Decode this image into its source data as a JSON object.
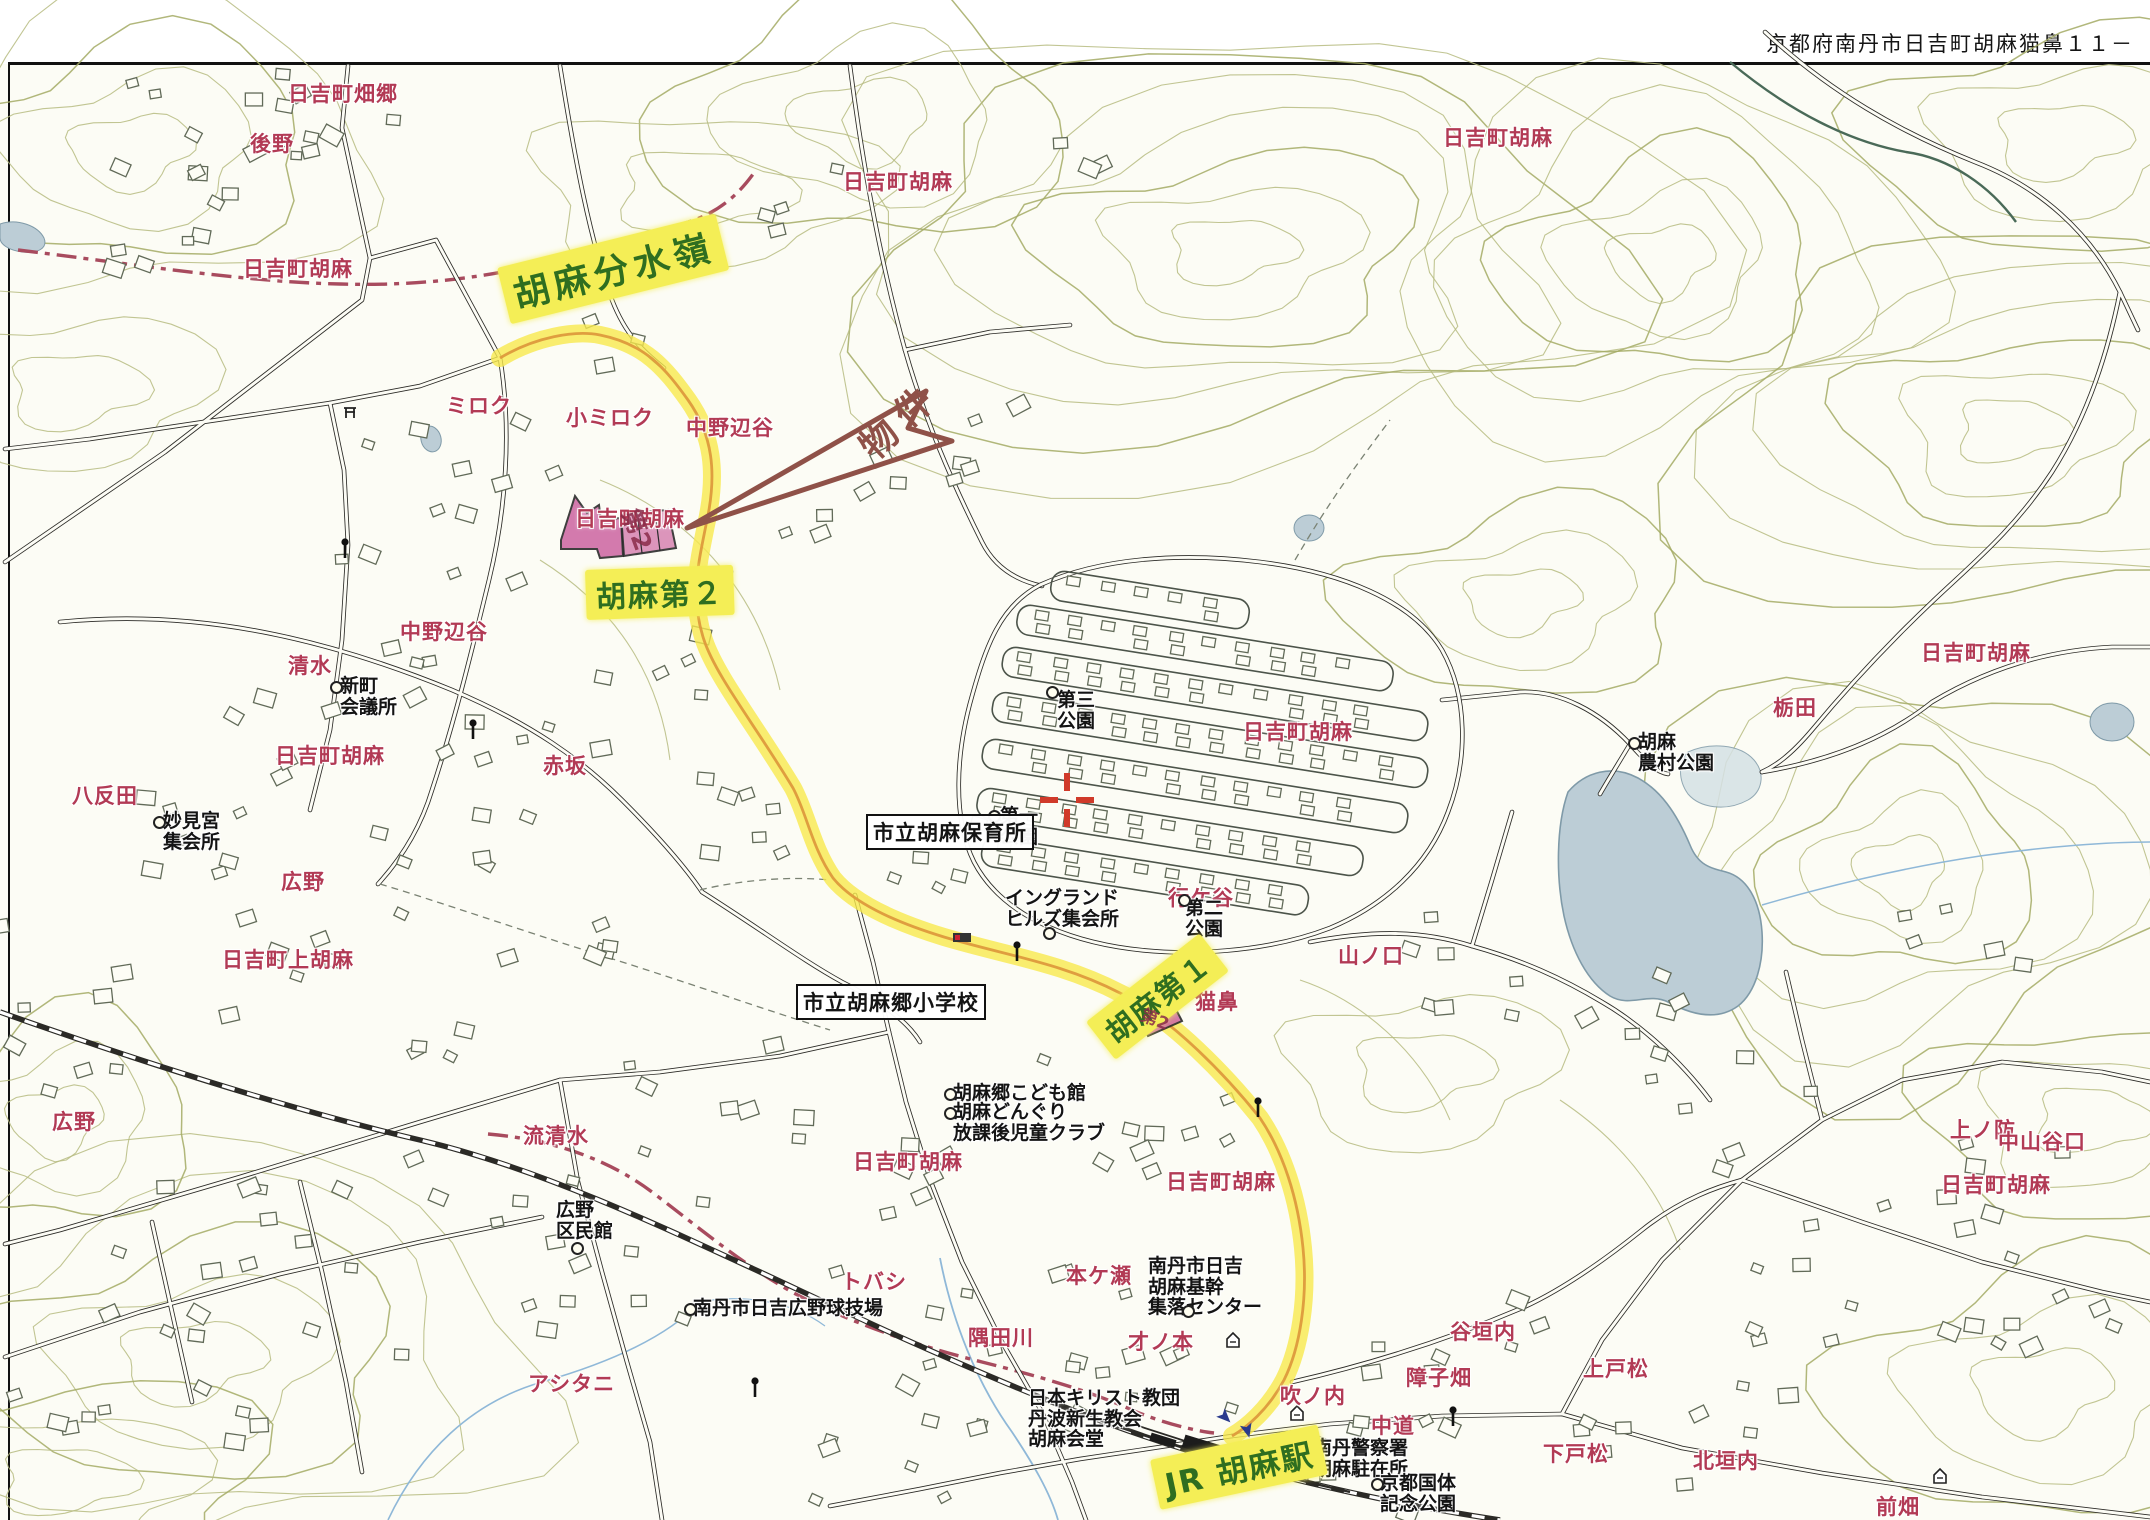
{
  "header": {
    "address_label": "京都府南丹市日吉町胡麻猫鼻１１－"
  },
  "map": {
    "colors": {
      "route_highlight": "#f8e84e",
      "route_center": "#dd9a3c",
      "label_highlight_bg": "#f4ee56",
      "label_highlight_text": "#2f6e20",
      "place_name_red": "#b23a55",
      "boundary_red": "#a84b5e",
      "flag_maroon": "#8f5148",
      "water_blue": "#bccdd6",
      "contour_olive": "#b6bb80",
      "property_pink": "#cf6da6",
      "crosshair_red": "#d03a2a",
      "rail_black": "#2b2a26"
    },
    "highlight_labels": [
      {
        "t": "胡麻分水嶺",
        "x": 497,
        "y": 268,
        "rot": -14,
        "size": 36,
        "ls": 5
      },
      {
        "t": "胡麻第２",
        "x": 585,
        "y": 570,
        "rot": -2,
        "size": 30,
        "ls": 2
      },
      {
        "t": "胡麻第１",
        "x": 1086,
        "y": 1022,
        "rot": -38,
        "size": 29,
        "ls": 2
      },
      {
        "t": "JR 胡麻駅",
        "x": 1150,
        "y": 1460,
        "rot": -12,
        "size": 31,
        "ls": 2
      }
    ],
    "flag_label": {
      "t": "物件",
      "x": 845,
      "y": 430,
      "rot": -43,
      "size": 37,
      "ls": 10
    },
    "handwritten_marks": [
      {
        "t": "第2",
        "x": 648,
        "y": 503,
        "rot": 70,
        "size": 25
      },
      {
        "t": "第2",
        "x": 1147,
        "y": 1001,
        "rot": 22,
        "size": 17
      }
    ],
    "red_labels": [
      {
        "t": "日吉町畑郷",
        "x": 288,
        "y": 78
      },
      {
        "t": "後野",
        "x": 250,
        "y": 128
      },
      {
        "t": "日吉町胡麻",
        "x": 243,
        "y": 253
      },
      {
        "t": "ミロク",
        "x": 446,
        "y": 390
      },
      {
        "t": "小ミロク",
        "x": 566,
        "y": 402
      },
      {
        "t": "中野辺谷",
        "x": 686,
        "y": 412
      },
      {
        "t": "中野辺谷",
        "x": 400,
        "y": 616
      },
      {
        "t": "清水",
        "x": 288,
        "y": 650
      },
      {
        "t": "八反田",
        "x": 72,
        "y": 780
      },
      {
        "t": "日吉町胡麻",
        "x": 575,
        "y": 503
      },
      {
        "t": "日吉町胡麻",
        "x": 275,
        "y": 740
      },
      {
        "t": "赤坂",
        "x": 543,
        "y": 750
      },
      {
        "t": "広野",
        "x": 281,
        "y": 866
      },
      {
        "t": "日吉町上胡麻",
        "x": 222,
        "y": 944
      },
      {
        "t": "広野",
        "x": 52,
        "y": 1106
      },
      {
        "t": "流清水",
        "x": 523,
        "y": 1120
      },
      {
        "t": "アシタニ",
        "x": 528,
        "y": 1368
      },
      {
        "t": "トバシ",
        "x": 841,
        "y": 1266
      },
      {
        "t": "隅田川",
        "x": 968,
        "y": 1322
      },
      {
        "t": "才ノ本",
        "x": 1128,
        "y": 1326
      },
      {
        "t": "本ケ瀬",
        "x": 1066,
        "y": 1260
      },
      {
        "t": "日吉町胡麻",
        "x": 853,
        "y": 1146
      },
      {
        "t": "日吉町胡麻",
        "x": 1166,
        "y": 1166
      },
      {
        "t": "吹ノ内",
        "x": 1280,
        "y": 1380
      },
      {
        "t": "中道",
        "x": 1371,
        "y": 1410
      },
      {
        "t": "障子畑",
        "x": 1406,
        "y": 1362
      },
      {
        "t": "谷垣内",
        "x": 1450,
        "y": 1316
      },
      {
        "t": "上戸松",
        "x": 1583,
        "y": 1353
      },
      {
        "t": "下戸松",
        "x": 1543,
        "y": 1438
      },
      {
        "t": "北垣内",
        "x": 1693,
        "y": 1445
      },
      {
        "t": "前畑",
        "x": 1876,
        "y": 1491
      },
      {
        "t": "山ノ口",
        "x": 1338,
        "y": 940
      },
      {
        "t": "行ケ谷",
        "x": 1168,
        "y": 882
      },
      {
        "t": "猫鼻",
        "x": 1195,
        "y": 986
      },
      {
        "t": "栃田",
        "x": 1773,
        "y": 692
      },
      {
        "t": "日吉町胡麻",
        "x": 843,
        "y": 166
      },
      {
        "t": "日吉町胡麻",
        "x": 1443,
        "y": 122
      },
      {
        "t": "日吉町胡麻",
        "x": 1921,
        "y": 637
      },
      {
        "t": "日吉町胡麻",
        "x": 1243,
        "y": 716
      },
      {
        "t": "上ノ防",
        "x": 1950,
        "y": 1114
      },
      {
        "t": "中山谷口",
        "x": 1998,
        "y": 1126
      },
      {
        "t": "日吉町胡麻",
        "x": 1941,
        "y": 1169
      }
    ],
    "black_labels": [
      {
        "lines": [
          "新町",
          "会議所"
        ],
        "x": 340,
        "y": 676,
        "dot": {
          "x": 330,
          "y": 681
        }
      },
      {
        "lines": [
          "妙見宮",
          "集会所"
        ],
        "x": 163,
        "y": 811,
        "dot": {
          "x": 153,
          "y": 816
        }
      },
      {
        "lines": [
          "第三",
          "公園"
        ],
        "x": 1057,
        "y": 690,
        "dot": {
          "x": 1046,
          "y": 686
        }
      },
      {
        "lines": [
          "第一",
          "公園"
        ],
        "x": 1000,
        "y": 806,
        "dot": {
          "x": 988,
          "y": 810
        }
      },
      {
        "lines": [
          "第二",
          "公園"
        ],
        "x": 1185,
        "y": 898,
        "dot": {
          "x": 1178,
          "y": 894
        }
      },
      {
        "lines": [
          "イングランド",
          "ヒルズ集会所"
        ],
        "x": 1005,
        "y": 888,
        "dot": {
          "x": 1043,
          "y": 927
        }
      },
      {
        "lines": [
          "胡麻",
          "農村公園"
        ],
        "x": 1638,
        "y": 732,
        "dot": {
          "x": 1628,
          "y": 737
        }
      },
      {
        "lines": [
          "胡麻郷こども館"
        ],
        "x": 953,
        "y": 1083,
        "dot": {
          "x": 944,
          "y": 1088
        }
      },
      {
        "lines": [
          "胡麻どんぐり",
          "放課後児童クラブ"
        ],
        "x": 953,
        "y": 1102,
        "dot": {
          "x": 944,
          "y": 1107
        }
      },
      {
        "lines": [
          "南丹市日吉",
          "胡麻基幹",
          "集落センター"
        ],
        "x": 1148,
        "y": 1256,
        "dot": {
          "x": 1182,
          "y": 1305
        }
      },
      {
        "lines": [
          "南丹市日吉広野球技場"
        ],
        "x": 693,
        "y": 1298,
        "dot": {
          "x": 684,
          "y": 1303
        }
      },
      {
        "lines": [
          "広野",
          "区民館"
        ],
        "x": 556,
        "y": 1200,
        "dot": {
          "x": 571,
          "y": 1242
        }
      },
      {
        "lines": [
          "日本キリスト教団",
          "丹波新生教会",
          "胡麻会堂"
        ],
        "x": 1028,
        "y": 1388
      },
      {
        "lines": [
          "南丹警察署",
          "胡麻駐在所"
        ],
        "x": 1313,
        "y": 1438,
        "dot": {
          "x": 1304,
          "y": 1444
        }
      },
      {
        "lines": [
          "京都国体",
          "記念公園"
        ],
        "x": 1380,
        "y": 1473,
        "dot": {
          "x": 1371,
          "y": 1478
        }
      }
    ],
    "boxed_labels": [
      {
        "t": "市立胡麻保育所",
        "x": 866,
        "y": 814
      },
      {
        "t": "市立胡麻郷小学校",
        "x": 796,
        "y": 984
      }
    ],
    "symbols": {
      "poles": [
        {
          "x": 345,
          "y": 540
        },
        {
          "x": 473,
          "y": 721
        },
        {
          "x": 755,
          "y": 1379
        },
        {
          "x": 1017,
          "y": 943
        },
        {
          "x": 1258,
          "y": 1099
        },
        {
          "x": 1453,
          "y": 1408
        }
      ],
      "torii": [
        {
          "x": 350,
          "y": 408
        }
      ],
      "building_marks": [
        {
          "x": 1233,
          "y": 1339
        },
        {
          "x": 1297,
          "y": 1412
        },
        {
          "x": 1940,
          "y": 1475
        }
      ],
      "bus_stop": {
        "x": 962,
        "y": 938
      },
      "station_arrows": [
        {
          "x": 1224,
          "y": 1416,
          "rot": 135
        },
        {
          "x": 1247,
          "y": 1429,
          "rot": 165
        }
      ],
      "crosshair": {
        "x": 1067,
        "y": 800
      }
    }
  }
}
